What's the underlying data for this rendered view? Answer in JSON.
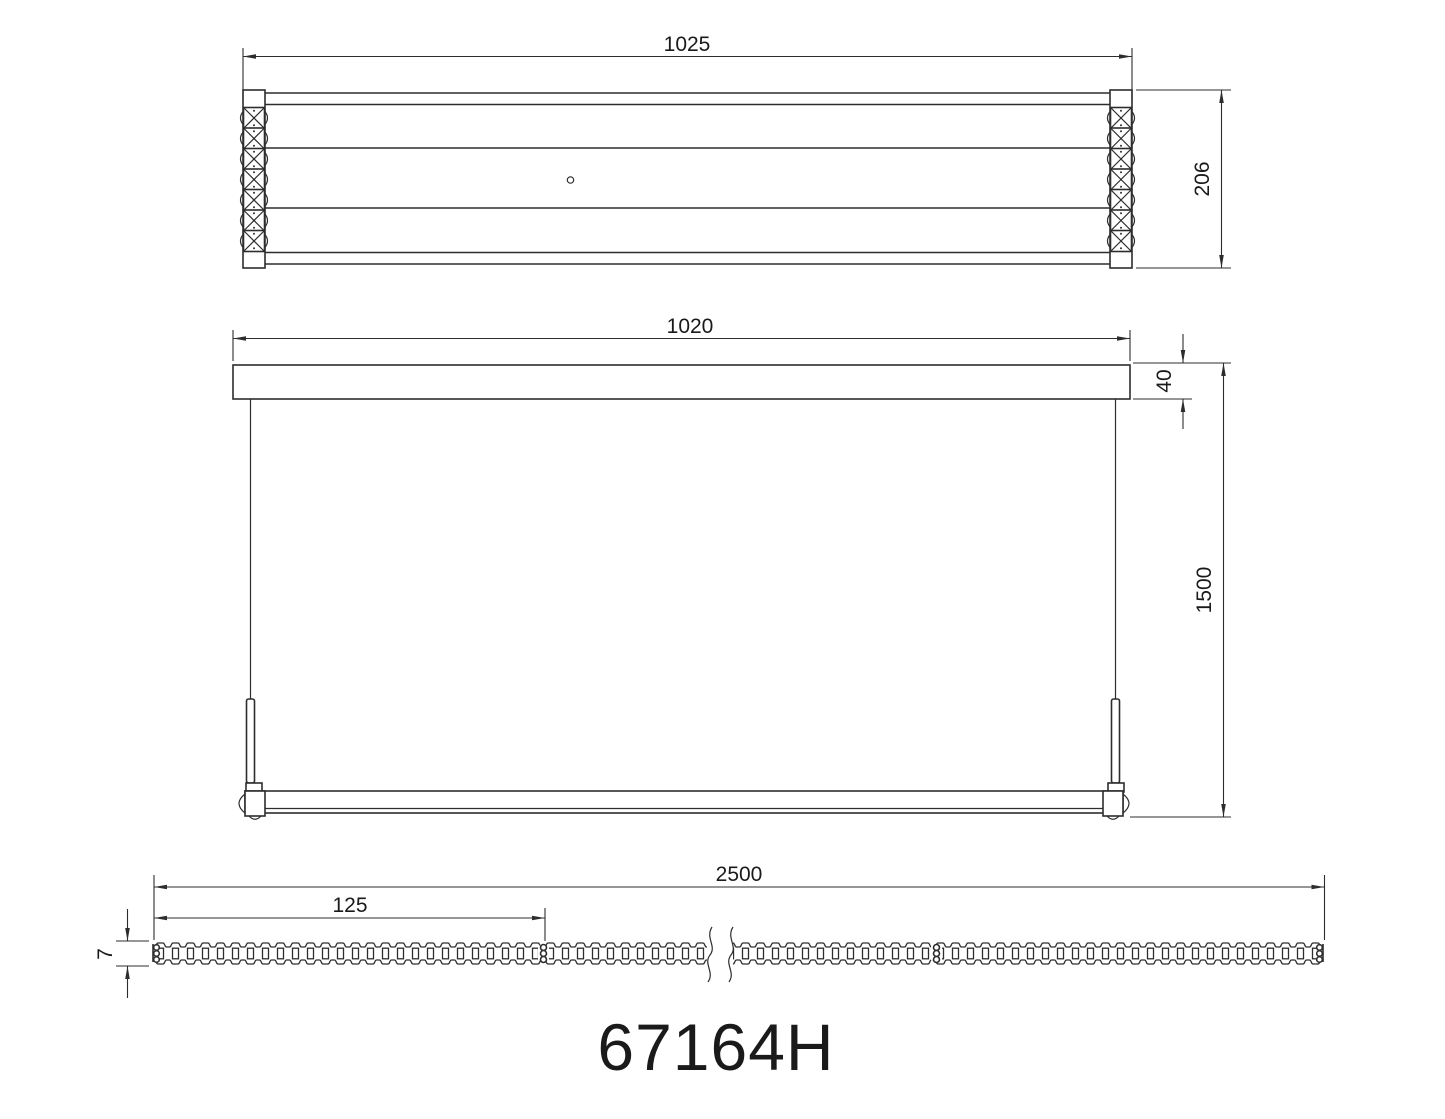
{
  "drawing": {
    "model_number": "67164H",
    "views": {
      "top_view": {
        "width_dim": "1025",
        "height_dim": "206",
        "crystals_per_side": 7
      },
      "front_view": {
        "width_dim": "1020",
        "canopy_height_dim": "40",
        "drop_height_dim": "1500"
      },
      "led_strip_view": {
        "length_dim": "2500",
        "cut_segment_dim": "125",
        "strip_width_dim": "7"
      }
    },
    "colors": {
      "line": "#2d2d2d",
      "text": "#1a1a1a",
      "background": "#ffffff"
    }
  }
}
